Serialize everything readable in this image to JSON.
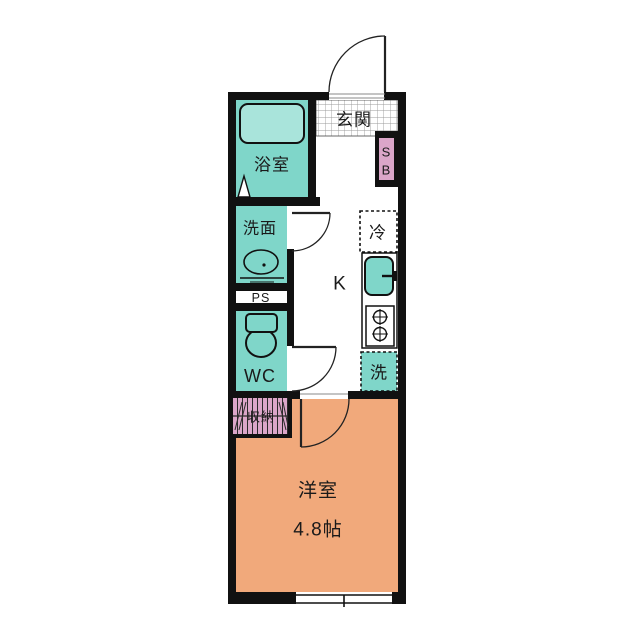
{
  "floorplan": {
    "labels": {
      "genkan": "玄関",
      "bathroom": "浴室",
      "washroom": "洗面",
      "pipe_space": "PS",
      "wc": "WC",
      "kitchen": "K",
      "refrigerator": "冷",
      "laundry": "洗",
      "shoebox_s": "S",
      "shoebox_b": "B",
      "storage": "収納",
      "western_room": "洋室",
      "western_room_size": "4.8帖"
    },
    "colors": {
      "wall": "#111111",
      "room_teal": "#7fd6c9",
      "bathtub_teal": "#a9e4db",
      "accent_pink": "#dba6c9",
      "room_orange": "#f1a97b",
      "tile_line": "#9b9b9b",
      "background": "#ffffff"
    }
  }
}
